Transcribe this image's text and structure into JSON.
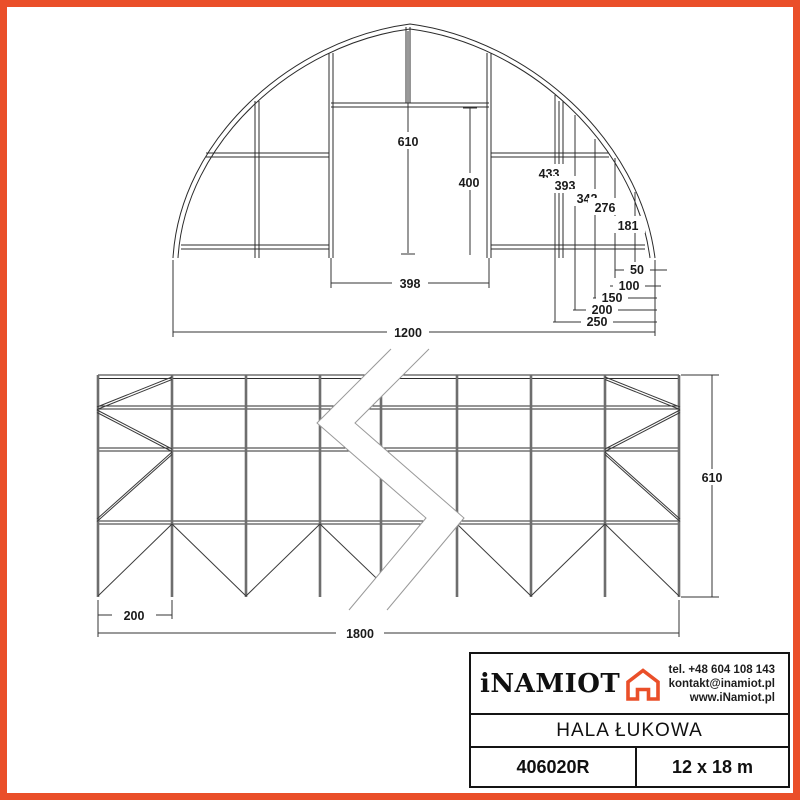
{
  "accent_color": "#EA4F29",
  "front_view": {
    "height_center": "610",
    "door_height": "400",
    "door_width": "398",
    "total_width": "1200",
    "arc_heights": [
      "433",
      "393",
      "342",
      "276",
      "181"
    ],
    "edge_offsets": [
      "50",
      "100",
      "150",
      "200",
      "250"
    ]
  },
  "side_view": {
    "bay_width": "200",
    "total_length": "1800",
    "height": "610"
  },
  "title_block": {
    "brand": "iNAMIOT",
    "phone": "tel. +48 604 108 143",
    "email": "kontakt@inamiot.pl",
    "website": "www.iNamiot.pl",
    "product_name": "HALA ŁUKOWA",
    "model": "406020R",
    "size": "12 x 18 m"
  }
}
